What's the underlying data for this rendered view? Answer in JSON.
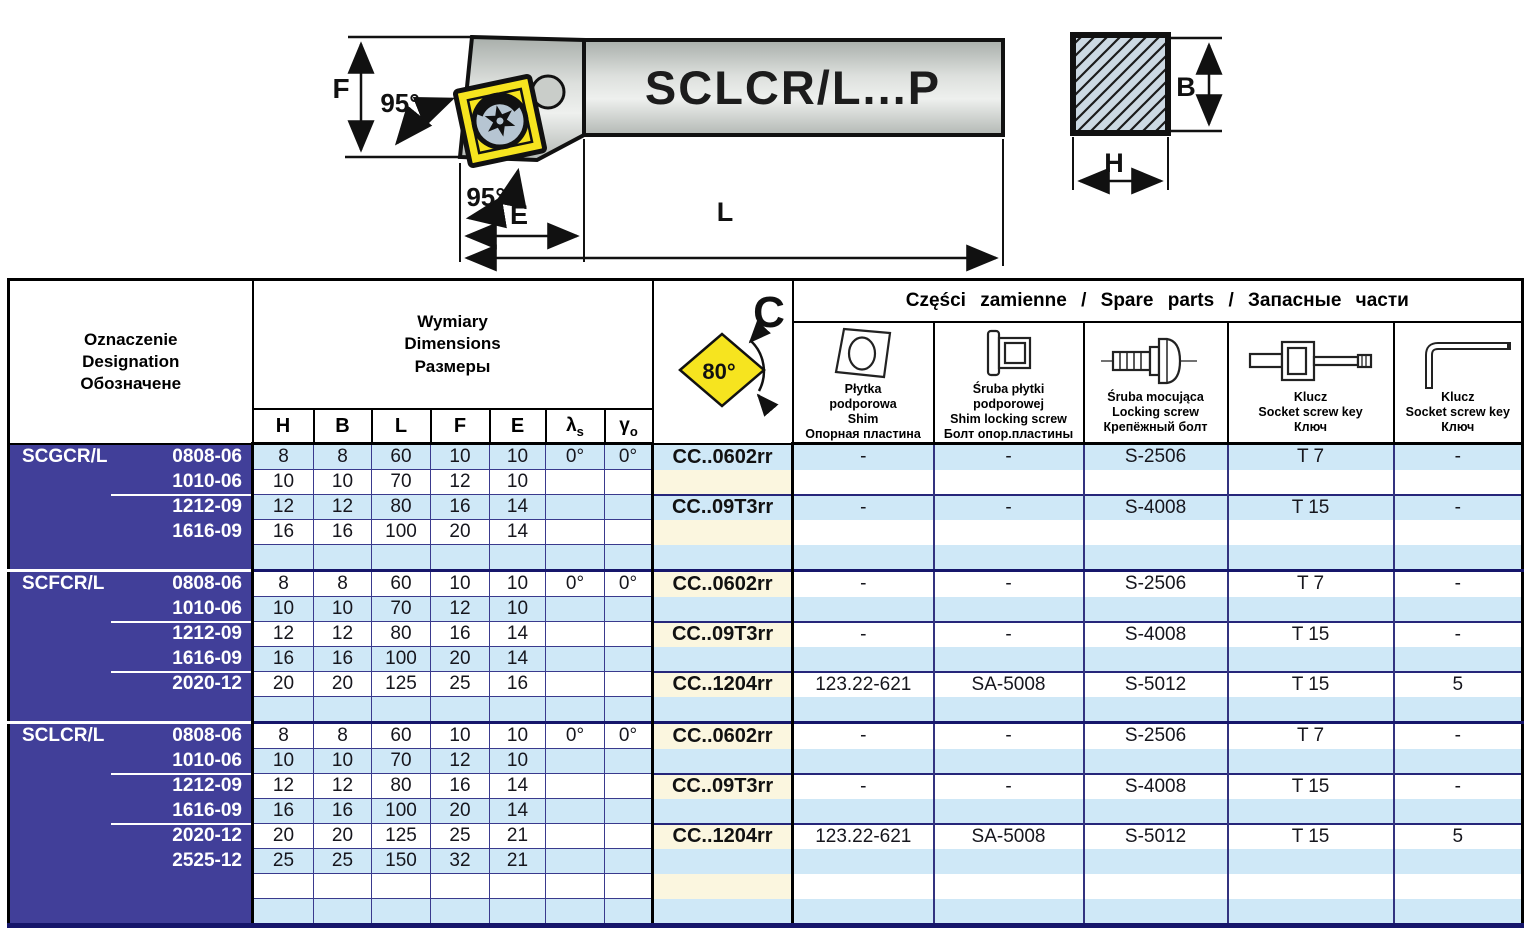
{
  "diagram": {
    "holder_label": "SCLCR/L...P",
    "dim_f": "F",
    "dim_e": "E",
    "dim_l": "L",
    "dim_b": "B",
    "dim_h": "H",
    "angle_top": "95°",
    "angle_bottom": "95°",
    "colors": {
      "insert_yellow": "#f6e41f",
      "steel_light": "#eceeec",
      "steel_dark": "#aab0ac",
      "section_fill": "#ccd9e3"
    }
  },
  "table": {
    "header": {
      "designation": "Oznaczenie\nDesignation\nОбозначене",
      "dimensions": "Wymiary\nDimensions\nРазмеры",
      "dim_cols": [
        "H",
        "B",
        "L",
        "F",
        "E"
      ],
      "lambda_base": "λ",
      "lambda_sub": "s",
      "gamma_base": "γ",
      "gamma_sub": "o",
      "c_label": "C",
      "insert_angle": "80°",
      "spare_title": "Części zamienne / Spare parts / Запасные части",
      "spare_cols": [
        {
          "icon": "shim-icon",
          "caption": "Płytka\npodporowa\nShim\nОпорная пластина"
        },
        {
          "icon": "shim-locking-screw-icon",
          "caption": "Śruba płytki\npodporowej\nShim locking screw\nБолт опор.пластины"
        },
        {
          "icon": "locking-screw-icon",
          "caption": "Śruba mocująca\nLocking screw\nКрепёжный болт"
        },
        {
          "icon": "socket-screw-key-icon",
          "caption": "Klucz\nSocket screw key\nКлюч"
        },
        {
          "icon": "hex-key-icon",
          "caption": "Klucz\nSocket screw key\nКлюч"
        }
      ]
    },
    "row_colors": {
      "stripe_blue": "#cfe8f7",
      "stripe_white": "#ffffff",
      "c_cream": "#fbf6df",
      "group_bg": "#413f99"
    },
    "groups": [
      {
        "name": "SCGCR/L",
        "subgroups": [
          {
            "c": "CC..0602rr",
            "spare": [
              "-",
              "-",
              "S-2506",
              "T 7",
              "-"
            ],
            "rows": [
              {
                "size": "0808-06",
                "dims": [
                  "8",
                  "8",
                  "60",
                  "10",
                  "10",
                  "0°",
                  "0°"
                ]
              },
              {
                "size": "1010-06",
                "dims": [
                  "10",
                  "10",
                  "70",
                  "12",
                  "10",
                  "",
                  ""
                ]
              }
            ]
          },
          {
            "c": "CC..09T3rr",
            "spare": [
              "-",
              "-",
              "S-4008",
              "T 15",
              "-"
            ],
            "rows": [
              {
                "size": "1212-09",
                "dims": [
                  "12",
                  "12",
                  "80",
                  "16",
                  "14",
                  "",
                  ""
                ]
              },
              {
                "size": "1616-09",
                "dims": [
                  "16",
                  "16",
                  "100",
                  "20",
                  "14",
                  "",
                  ""
                ]
              },
              {
                "size": "",
                "dims": [
                  "",
                  "",
                  "",
                  "",
                  "",
                  "",
                  ""
                ]
              }
            ]
          }
        ]
      },
      {
        "name": "SCFCR/L",
        "subgroups": [
          {
            "c": "CC..0602rr",
            "spare": [
              "-",
              "-",
              "S-2506",
              "T 7",
              "-"
            ],
            "rows": [
              {
                "size": "0808-06",
                "dims": [
                  "8",
                  "8",
                  "60",
                  "10",
                  "10",
                  "0°",
                  "0°"
                ]
              },
              {
                "size": "1010-06",
                "dims": [
                  "10",
                  "10",
                  "70",
                  "12",
                  "10",
                  "",
                  ""
                ]
              }
            ]
          },
          {
            "c": "CC..09T3rr",
            "spare": [
              "-",
              "-",
              "S-4008",
              "T 15",
              "-"
            ],
            "rows": [
              {
                "size": "1212-09",
                "dims": [
                  "12",
                  "12",
                  "80",
                  "16",
                  "14",
                  "",
                  ""
                ]
              },
              {
                "size": "1616-09",
                "dims": [
                  "16",
                  "16",
                  "100",
                  "20",
                  "14",
                  "",
                  ""
                ]
              }
            ]
          },
          {
            "c": "CC..1204rr",
            "spare": [
              "123.22-621",
              "SA-5008",
              "S-5012",
              "T 15",
              "5"
            ],
            "rows": [
              {
                "size": "2020-12",
                "dims": [
                  "20",
                  "20",
                  "125",
                  "25",
                  "16",
                  "",
                  ""
                ]
              },
              {
                "size": "",
                "dims": [
                  "",
                  "",
                  "",
                  "",
                  "",
                  "",
                  ""
                ]
              }
            ]
          }
        ]
      },
      {
        "name": "SCLCR/L",
        "subgroups": [
          {
            "c": "CC..0602rr",
            "spare": [
              "-",
              "-",
              "S-2506",
              "T 7",
              "-"
            ],
            "rows": [
              {
                "size": "0808-06",
                "dims": [
                  "8",
                  "8",
                  "60",
                  "10",
                  "10",
                  "0°",
                  "0°"
                ]
              },
              {
                "size": "1010-06",
                "dims": [
                  "10",
                  "10",
                  "70",
                  "12",
                  "10",
                  "",
                  ""
                ]
              }
            ]
          },
          {
            "c": "CC..09T3rr",
            "spare": [
              "-",
              "-",
              "S-4008",
              "T 15",
              "-"
            ],
            "rows": [
              {
                "size": "1212-09",
                "dims": [
                  "12",
                  "12",
                  "80",
                  "16",
                  "14",
                  "",
                  ""
                ]
              },
              {
                "size": "1616-09",
                "dims": [
                  "16",
                  "16",
                  "100",
                  "20",
                  "14",
                  "",
                  ""
                ]
              }
            ]
          },
          {
            "c": "CC..1204rr",
            "spare": [
              "123.22-621",
              "SA-5008",
              "S-5012",
              "T 15",
              "5"
            ],
            "rows": [
              {
                "size": "2020-12",
                "dims": [
                  "20",
                  "20",
                  "125",
                  "25",
                  "21",
                  "",
                  ""
                ]
              },
              {
                "size": "2525-12",
                "dims": [
                  "25",
                  "25",
                  "150",
                  "32",
                  "21",
                  "",
                  ""
                ]
              },
              {
                "size": "",
                "dims": [
                  "",
                  "",
                  "",
                  "",
                  "",
                  "",
                  ""
                ]
              },
              {
                "size": "",
                "dims": [
                  "",
                  "",
                  "",
                  "",
                  "",
                  "",
                  ""
                ]
              }
            ]
          }
        ]
      }
    ]
  }
}
